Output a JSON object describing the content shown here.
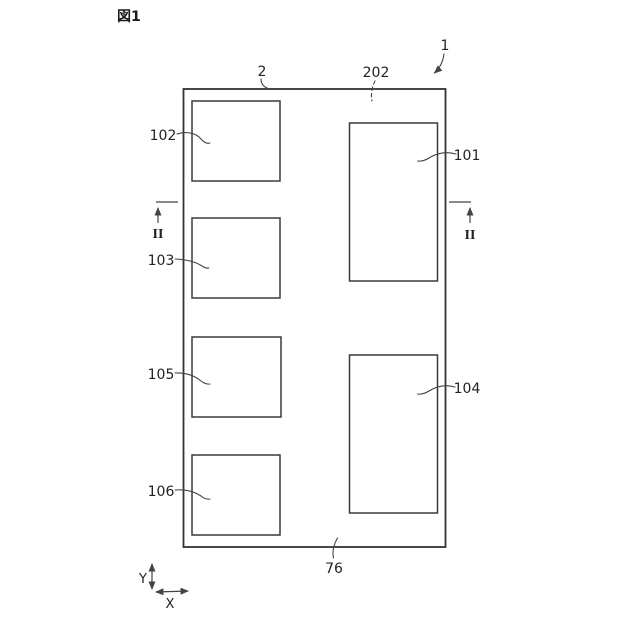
{
  "figure": {
    "caption": "図1",
    "colors": {
      "background": "#ffffff",
      "line": "#333333",
      "text": "#222222"
    },
    "reference_labels": {
      "body": "1",
      "top_surface": "2",
      "inner_region": "202",
      "block_101": "101",
      "block_102": "102",
      "block_103": "103",
      "block_104": "104",
      "block_105": "105",
      "block_106": "106",
      "bottom_edge": "76"
    },
    "section_markers": {
      "left": "II",
      "right": "II"
    },
    "axes": {
      "horizontal": "X",
      "vertical": "Y"
    }
  }
}
